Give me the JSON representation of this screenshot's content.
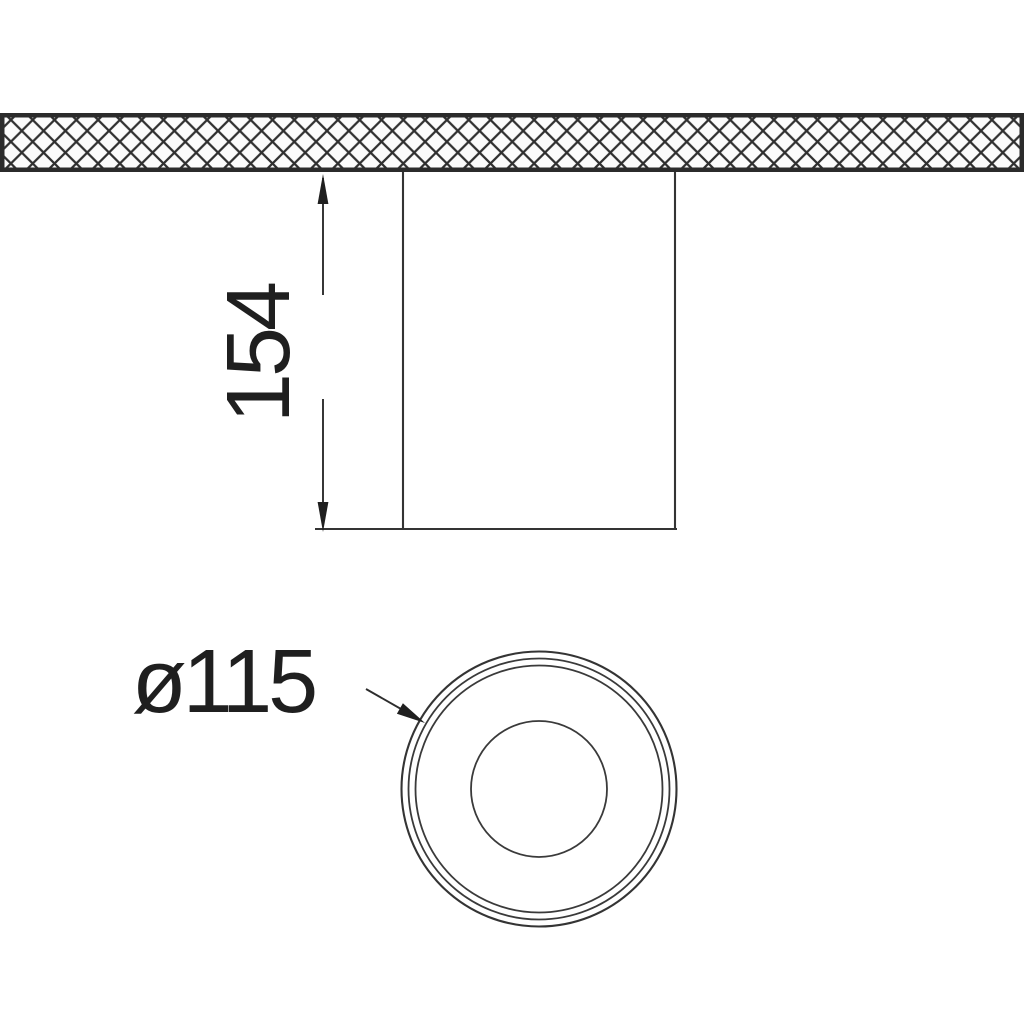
{
  "drawing": {
    "type": "technical-dimension-drawing",
    "subject": "surface-mounted-cylindrical-downlight",
    "dimensions": {
      "height": {
        "label": "154"
      },
      "diameter": {
        "label": "ø115"
      }
    },
    "colors": {
      "line": "#3a3a3a",
      "band_line": "#2b2b2b",
      "text": "#1f1f1f",
      "background": "#ffffff",
      "hatch_cell": "#fbfbfb"
    }
  }
}
